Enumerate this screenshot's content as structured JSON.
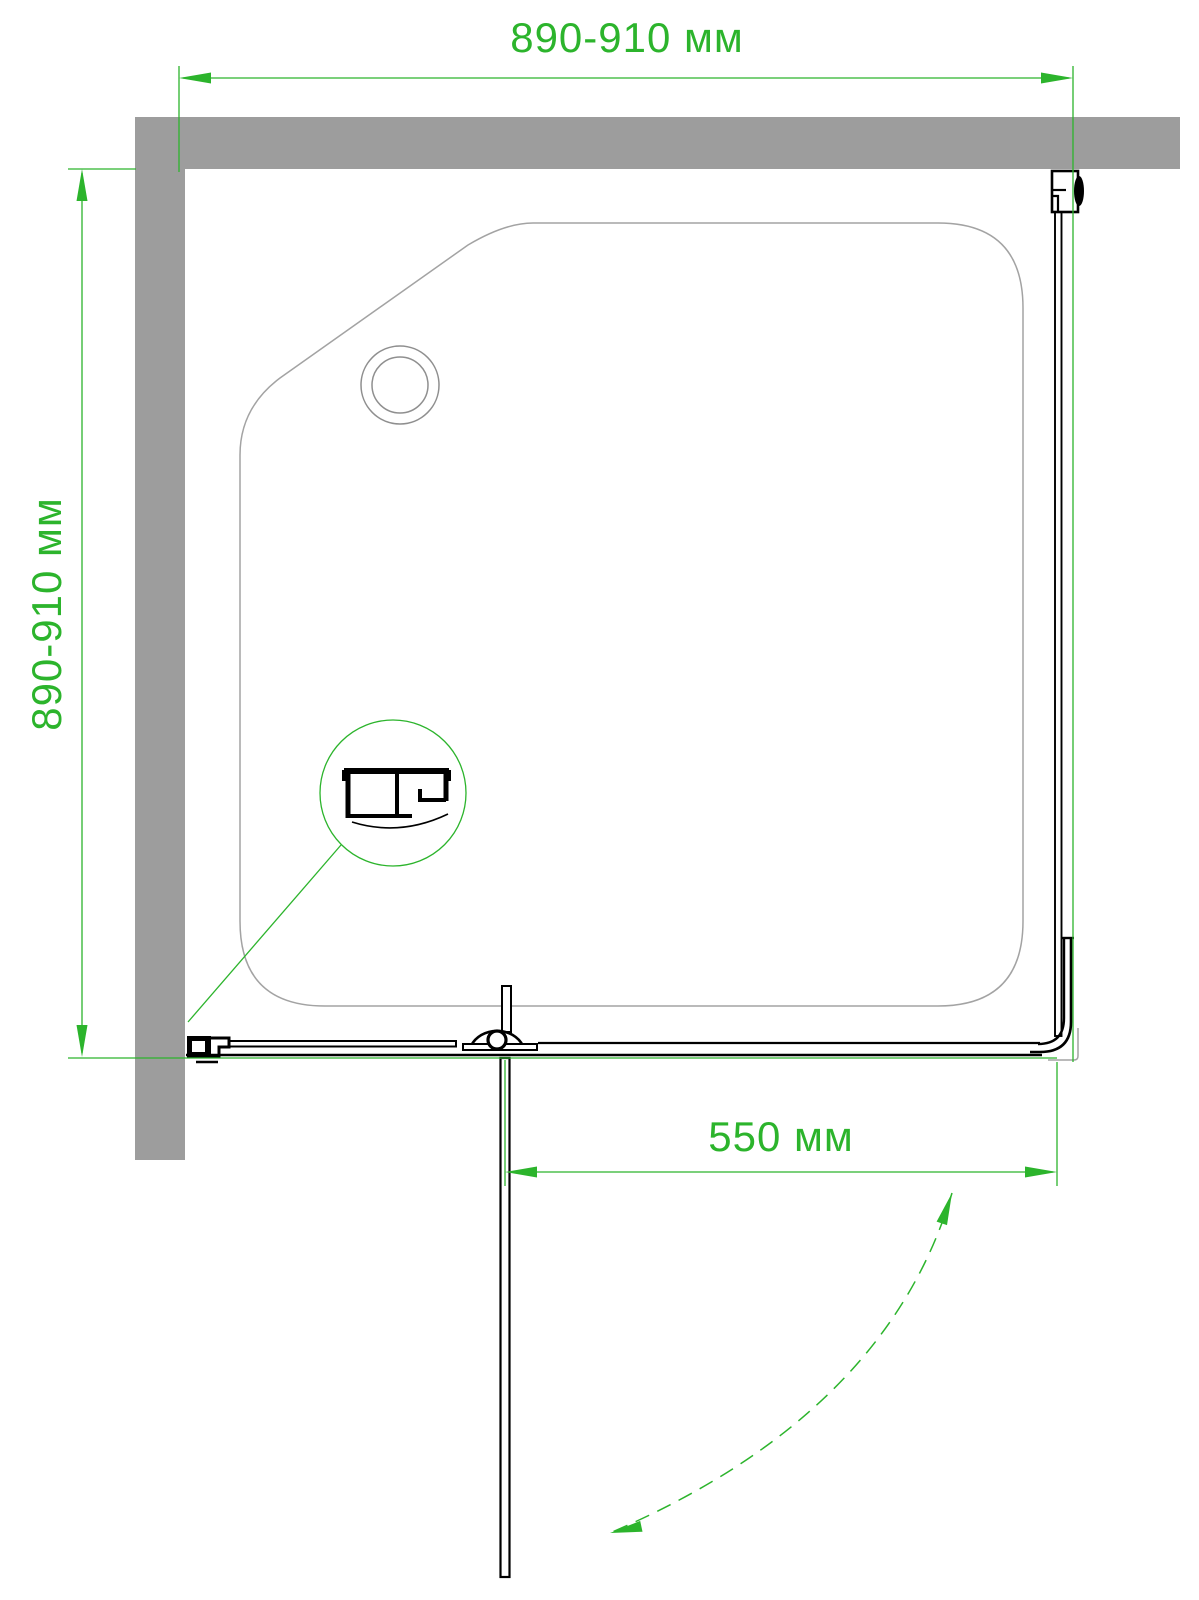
{
  "drawing": {
    "title": "shower-enclosure-top-view",
    "dimensions": {
      "top_width": {
        "label": "890-910 мм"
      },
      "left_depth": {
        "label": "890-910 мм"
      },
      "door_width": {
        "label": "550 мм"
      }
    },
    "colors": {
      "dimension_green": "#2cb42c",
      "wall_gray": "#9d9d9d",
      "tray_line_gray": "#a3a3a3",
      "profile_black": "#000000",
      "background": "#ffffff"
    }
  }
}
